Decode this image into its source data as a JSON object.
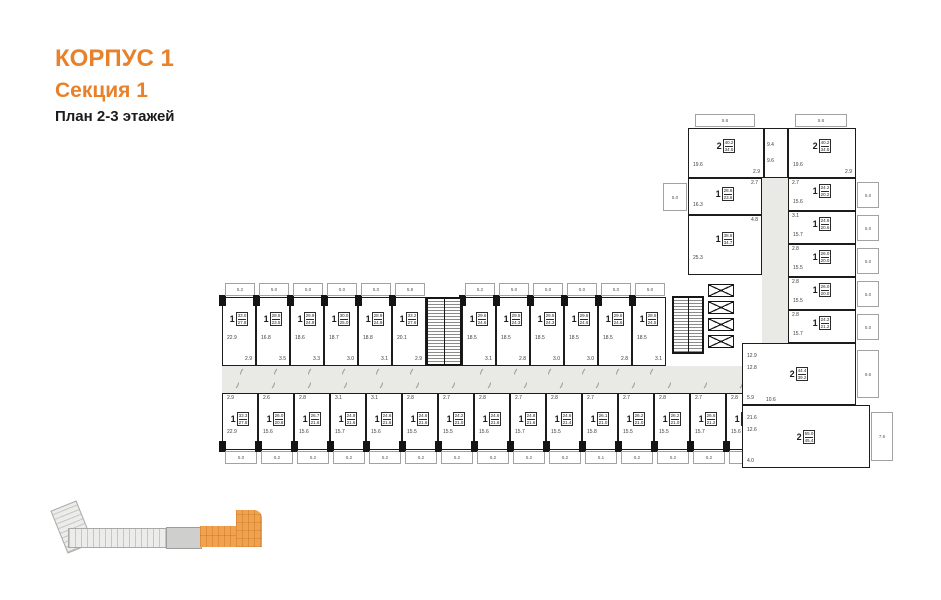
{
  "header": {
    "building": "КОРПУС 1",
    "section": "Секция 1",
    "floors": "План 2-3 этажей"
  },
  "colors": {
    "accent_orange": "#E8812B",
    "minimap_highlight": "#F2A24C",
    "wall_black": "#1C1C1C",
    "corridor_gray": "#E9E9E6"
  },
  "plan": {
    "features": {
      "elevators_visible": 4,
      "stairwells_visible": 2
    },
    "top_row": [
      {
        "rooms": "1",
        "total": "33.0",
        "living": "27.8",
        "room": "22.9",
        "hall": "2.9",
        "balcony": "5.2"
      },
      {
        "rooms": "1",
        "total": "28.5",
        "living": "23.5",
        "room": "16.8",
        "hall": "3.5",
        "balcony": "5.0"
      },
      {
        "rooms": "1",
        "total": "29.9",
        "living": "24.9",
        "room": "18.6",
        "hall": "3.3",
        "balcony": "5.0"
      },
      {
        "rooms": "1",
        "total": "30.0",
        "living": "25.0",
        "room": "18.7",
        "hall": "3.0",
        "balcony": "5.0"
      },
      {
        "rooms": "1",
        "total": "28.9",
        "living": "24.9",
        "room": "18.8",
        "hall": "3.1",
        "balcony": "5.0"
      },
      {
        "rooms": "1",
        "total": "33.2",
        "living": "27.6",
        "room": "20.1",
        "hall": "2.9",
        "balcony": "5.8"
      },
      {
        "rooms": "1",
        "total": "29.6",
        "living": "24.6",
        "room": "18.5",
        "hall": "3.1",
        "balcony": "5.2"
      },
      {
        "rooms": "1",
        "total": "29.5",
        "living": "24.3",
        "room": "18.5",
        "hall": "2.8",
        "balcony": "5.0"
      },
      {
        "rooms": "1",
        "total": "29.5",
        "living": "24.3",
        "room": "18.5",
        "hall": "3.0",
        "balcony": "5.0"
      },
      {
        "rooms": "1",
        "total": "29.6",
        "living": "24.6",
        "room": "18.5",
        "hall": "3.0",
        "balcony": "5.0"
      },
      {
        "rooms": "1",
        "total": "29.6",
        "living": "24.6",
        "room": "18.5",
        "hall": "2.8",
        "balcony": "5.0"
      },
      {
        "rooms": "1",
        "total": "28.5",
        "living": "24.5",
        "room": "18.5",
        "hall": "3.1",
        "balcony": "5.0"
      }
    ],
    "bottom_row": [
      {
        "rooms": "1",
        "total": "33.3",
        "living": "27.8",
        "room": "22.9",
        "hall": "2.9",
        "balcony": "5.0"
      },
      {
        "rooms": "1",
        "total": "26.0",
        "living": "20.8",
        "room": "15.6",
        "hall": "2.6",
        "balcony": "5.2"
      },
      {
        "rooms": "1",
        "total": "26.7",
        "living": "21.6",
        "room": "15.6",
        "hall": "2.8",
        "balcony": "5.2"
      },
      {
        "rooms": "1",
        "total": "24.8",
        "living": "21.6",
        "room": "15.7",
        "hall": "3.1",
        "balcony": "5.2"
      },
      {
        "rooms": "1",
        "total": "24.6",
        "living": "21.6",
        "room": "15.6",
        "hall": "3.1",
        "balcony": "5.2"
      },
      {
        "rooms": "1",
        "total": "24.6",
        "living": "21.6",
        "room": "15.5",
        "hall": "2.8",
        "balcony": "5.2"
      },
      {
        "rooms": "1",
        "total": "24.2",
        "living": "21.0",
        "room": "15.5",
        "hall": "2.7",
        "balcony": "5.2"
      },
      {
        "rooms": "1",
        "total": "24.6",
        "living": "21.6",
        "room": "15.6",
        "hall": "2.8",
        "balcony": "5.2"
      },
      {
        "rooms": "1",
        "total": "24.8",
        "living": "21.6",
        "room": "15.7",
        "hall": "2.7",
        "balcony": "5.2"
      },
      {
        "rooms": "1",
        "total": "24.6",
        "living": "21.4",
        "room": "15.5",
        "hall": "2.8",
        "balcony": "5.2"
      },
      {
        "rooms": "1",
        "total": "26.1",
        "living": "21.0",
        "room": "15.8",
        "hall": "2.7",
        "balcony": "5.1"
      },
      {
        "rooms": "1",
        "total": "26.2",
        "living": "21.0",
        "room": "15.5",
        "hall": "2.7",
        "balcony": "5.2"
      },
      {
        "rooms": "1",
        "total": "26.2",
        "living": "21.0",
        "room": "15.5",
        "hall": "2.8",
        "balcony": "5.2"
      },
      {
        "rooms": "1",
        "total": "26.6",
        "living": "21.2",
        "room": "15.7",
        "hall": "2.7",
        "balcony": "5.2"
      },
      {
        "rooms": "1",
        "total": "27.0",
        "living": "21.8",
        "room": "15.6",
        "hall": "2.8",
        "balcony": "5.2"
      }
    ],
    "right_wing": {
      "top_units": [
        {
          "rooms": "2",
          "total": "40.2",
          "living": "34.5",
          "room": "19.6",
          "hall": "2.9",
          "balcony": "5.8"
        },
        {
          "rooms": "2",
          "total": "40.2",
          "living": "34.5",
          "room": "19.6",
          "hall": "2.9",
          "balcony": "5.8"
        }
      ],
      "vestibule": {
        "left": "9.4",
        "right": "9.6"
      },
      "left_units": [
        {
          "rooms": "1",
          "total": "28.6",
          "living": "23.6",
          "room": "16.3",
          "hall": "2.7",
          "balcony": "5.0"
        },
        {
          "rooms": "1",
          "total": "38.6",
          "living": "34.7",
          "room": "25.3",
          "hall": "4.8"
        }
      ],
      "right_units": [
        {
          "rooms": "1",
          "total": "24.2",
          "living": "20.2",
          "room": "15.6",
          "hall": "2.7",
          "balcony": "5.0"
        },
        {
          "rooms": "1",
          "total": "24.6",
          "living": "20.6",
          "room": "15.7",
          "hall": "3.1",
          "balcony": "5.0"
        },
        {
          "rooms": "1",
          "total": "26.0",
          "living": "20.0",
          "room": "15.5",
          "hall": "2.8",
          "balcony": "5.0"
        },
        {
          "rooms": "1",
          "total": "26.0",
          "living": "20.0",
          "room": "15.5",
          "hall": "2.8",
          "balcony": "5.0"
        },
        {
          "rooms": "1",
          "total": "24.2",
          "living": "21.2",
          "room": "15.7",
          "hall": "2.8",
          "balcony": "5.0"
        }
      ],
      "bottom_units": [
        {
          "rooms": "2",
          "total": "44.4",
          "living": "39.2",
          "room": "12.9",
          "room2": "12.8",
          "hall": "5.9",
          "balcony": "9.6"
        },
        {
          "rooms": "2",
          "total": "55.0",
          "living": "45.4",
          "room": "21.6",
          "room2": "12.6",
          "hall": "4.0",
          "balcony": "7.6"
        }
      ],
      "lobby": "10.6"
    }
  }
}
